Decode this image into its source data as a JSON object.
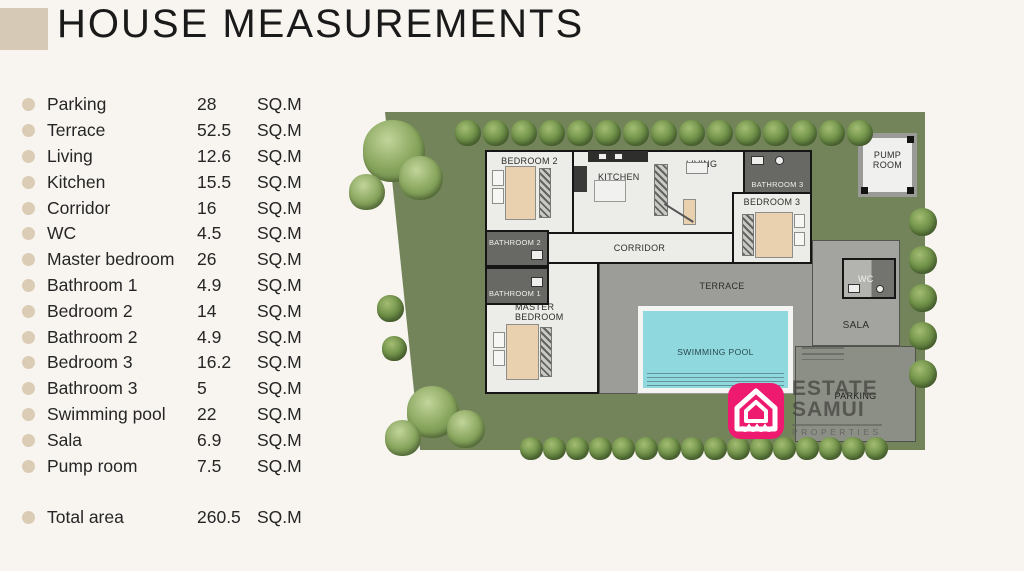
{
  "page": {
    "title": "HOUSE MEASUREMENTS",
    "unit": "SQ.M"
  },
  "measurements": [
    {
      "label": "Parking",
      "value": "28"
    },
    {
      "label": "Terrace",
      "value": "52.5"
    },
    {
      "label": "Living",
      "value": "12.6"
    },
    {
      "label": "Kitchen",
      "value": "15.5"
    },
    {
      "label": "Corridor",
      "value": "16"
    },
    {
      "label": "WC",
      "value": "4.5"
    },
    {
      "label": "Master bedroom",
      "value": "26"
    },
    {
      "label": "Bathroom 1",
      "value": "4.9"
    },
    {
      "label": "Bedroom 2",
      "value": "14"
    },
    {
      "label": "Bathroom 2",
      "value": "4.9"
    },
    {
      "label": "Bedroom 3",
      "value": "16.2"
    },
    {
      "label": "Bathroom 3",
      "value": "5"
    },
    {
      "label": "Swimming pool",
      "value": "22"
    },
    {
      "label": "Sala",
      "value": "6.9"
    },
    {
      "label": "Pump room",
      "value": "7.5"
    }
  ],
  "total": {
    "label": "Total area",
    "value": "260.5"
  },
  "plan": {
    "rooms": {
      "bedroom2": "BEDROOM 2",
      "kitchen": "KITCHEN",
      "living": "LIVING",
      "bathroom3": "BATHROOM 3",
      "bedroom3": "BEDROOM 3",
      "corridor": "CORRIDOR",
      "bathroom2": "BATHROOM 2",
      "bathroom1": "BATHROOM 1",
      "master_line1": "MASTER",
      "master_line2": "BEDROOM",
      "terrace": "TERRACE",
      "pool": "SWIMMING POOL",
      "wc": "WC",
      "sala": "SALA",
      "parking": "PARKING",
      "pump_line1": "PUMP",
      "pump_line2": "ROOM"
    },
    "logo": {
      "line1": "ESTATE",
      "line2": "SAMUI",
      "line3": "PROPERTIES"
    },
    "colors": {
      "accent_beige": "#d6c9b6",
      "grass_green": "#73845a",
      "tree_green": "#5d7c3e",
      "terrace_gray": "#9c9c98",
      "pool_cyan": "#8fd9de",
      "logo_pink": "#ee1a70"
    }
  }
}
